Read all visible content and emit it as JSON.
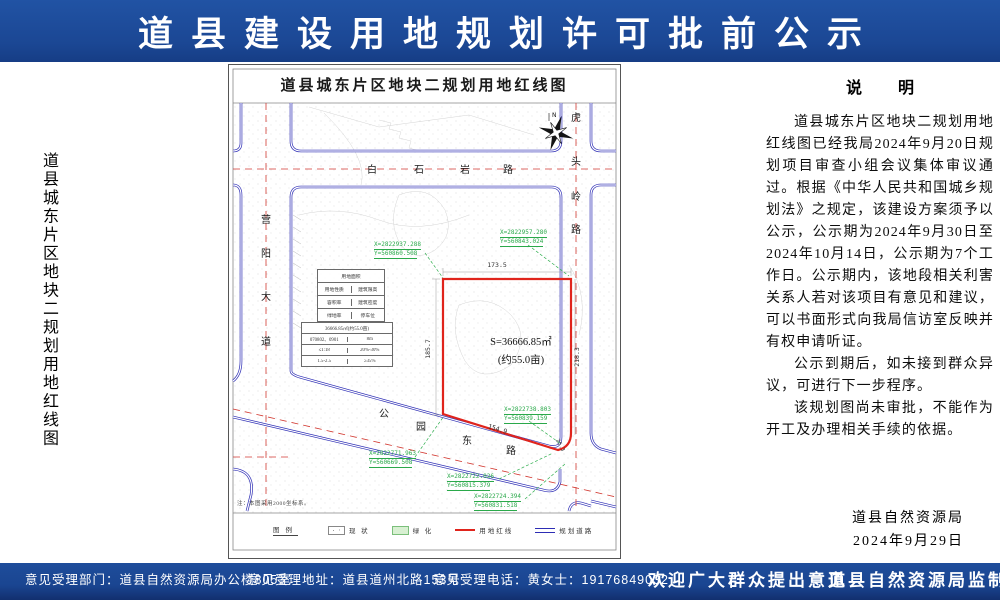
{
  "banner": {
    "title": "道县建设用地规划许可批前公示"
  },
  "side_title": "道县城东片区地块二规划用地红线图",
  "map": {
    "title": "道县城东片区地块二规划用地红线图",
    "compass_n": "N",
    "roads": {
      "baishiyan": {
        "name": "白石岩路",
        "chars": [
          "白",
          "石",
          "岩",
          "路"
        ]
      },
      "yingyang": {
        "name": "营阳大道",
        "chars": [
          "营",
          "阳",
          "大",
          "道"
        ]
      },
      "hutouling": {
        "name": "虎头岭路",
        "chars": [
          "虎",
          "头",
          "岭",
          "路"
        ]
      },
      "gongyuandong": {
        "name": "公园东路",
        "chars": [
          "公",
          "园",
          "东",
          "路"
        ]
      }
    },
    "parcel": {
      "area": "S=36666.85㎡",
      "mu": "(约55.0亩)"
    },
    "dims": {
      "top": "173.5",
      "left": "185.7",
      "right": "218.3",
      "bottom": "154.9",
      "corner": "25.3"
    },
    "coords": [
      {
        "x": "X=2822937.288",
        "y": "Y=560860.508"
      },
      {
        "x": "X=2822957.280",
        "y": "Y=560843.024"
      },
      {
        "x": "X=2822738.803",
        "y": "Y=560839.159"
      },
      {
        "x": "X=2822771.963",
        "y": "Y=560669.508"
      },
      {
        "x": "X=2822722.026",
        "y": "Y=560815.379"
      },
      {
        "x": "X=2822724.394",
        "y": "Y=560831.518"
      }
    ],
    "table1": {
      "r1": "用地面积",
      "r2": [
        "用地性质",
        "建筑限高"
      ],
      "r3": [
        "容积率",
        "建筑密度"
      ],
      "r4": [
        "绿地率",
        "停车位"
      ]
    },
    "table2": {
      "r1": "36666.85㎡(约55.0亩)",
      "r2": [
        "070802、0901",
        "8m"
      ],
      "r3": [
        "≤1:18",
        "20%-30%"
      ],
      "r4": [
        "1.5-2.5",
        "≥35%"
      ]
    },
    "note": "注：本图采用2000坐标系。",
    "legend": {
      "title": "图例",
      "items": [
        "现 状",
        "绿 化",
        "用地红线",
        "规划道路"
      ]
    }
  },
  "notice": {
    "heading": "说　明",
    "paragraphs": [
      "道县城东片区地块二规划用地红线图已经我局2024年9月20日规划项目审查小组会议集体审议通过。根据《中华人民共和国城乡规划法》之规定，该建设方案须予以公示，公示期为2024年9月30日至2024年10月14日，公示期为7个工作日。公示期内，该地段相关利害关系人若对该项目有意见和建议，可以书面形式向我局信访室反映并有权申请听证。",
      "公示到期后，如未接到群众异议，可进行下一步程序。",
      "该规划图尚未审批，不能作为开工及办理相关手续的依据。"
    ],
    "org": "道县自然资源局",
    "date": "2024年9月29日"
  },
  "footer": {
    "dept": "意见受理部门：道县自然资源局办公楼805室",
    "addr": "意见受理地址：道县道州北路153号",
    "phone": "意见受理电话：黄女士：19176849032",
    "welcome": "欢迎广大群众提出意见",
    "producer": "道县自然资源局监制"
  }
}
